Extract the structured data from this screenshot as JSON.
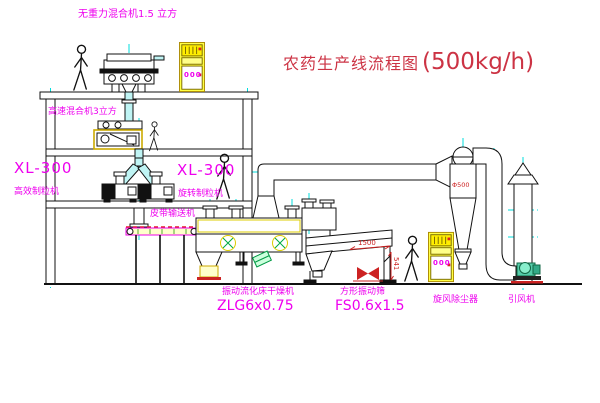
{
  "title": {
    "text_cn": "农药生产线流程图",
    "capacity": "(500kg/h)"
  },
  "labels": {
    "mixer_top": "无重力混合机1.5 立方",
    "mixer_second": "高速混合机3立方",
    "granulator_left_model": "XL-300",
    "granulator_left_name": "高效制粒机",
    "granulator_right_model": "XL-300",
    "granulator_right_name": "旋转制粒机",
    "belt_conveyor": "皮带输送机",
    "dryer_name": "振动流化床干燥机",
    "dryer_model": "ZLG6x0.75",
    "sieve_name": "方形振动筛",
    "sieve_model": "FS0.6x1.5",
    "cyclone_name": "旋风除尘器",
    "fan_name": "引风机"
  },
  "dimensions": {
    "sieve_length": "1500",
    "sieve_height": "541",
    "cyclone_note": "Φ500"
  },
  "control_cabinet": {
    "display": "000"
  },
  "colors": {
    "label_magenta": "#ee00ee",
    "title_red": "#cc3344",
    "centerline_cyan": "#00dddd",
    "cabinet_yellow": "#ffee00",
    "machine_accent_yellow": "#ccaa00",
    "dim_red": "#cc2222",
    "fan_green": "#2a9d77",
    "chute_cyan_fill": "#bff4f4"
  }
}
